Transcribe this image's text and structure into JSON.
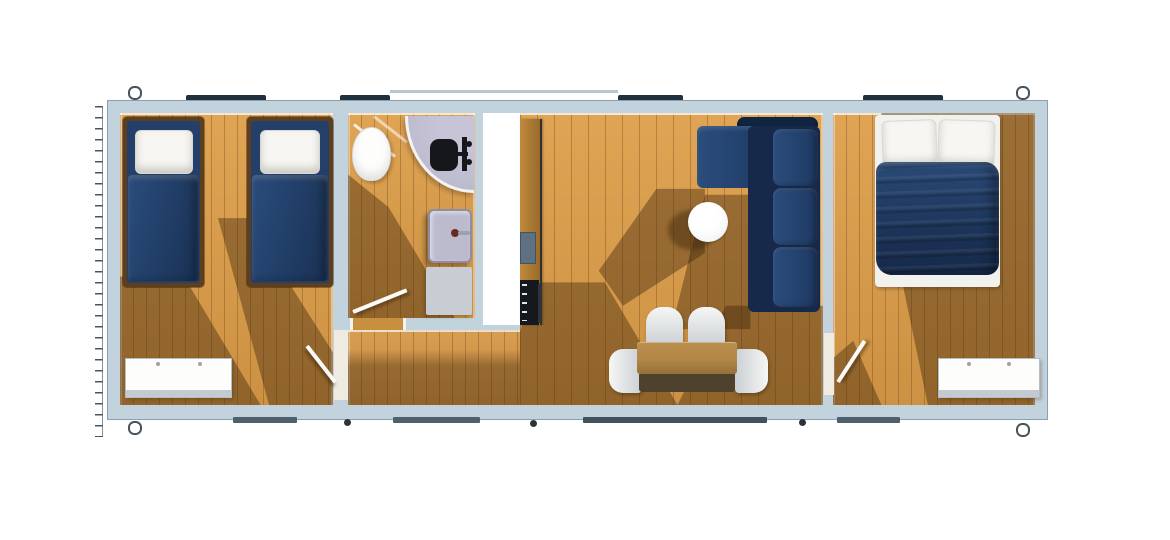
{
  "meta": {
    "kind": "floor-plan-render",
    "view": "top-down",
    "modules": 3
  },
  "colors": {
    "wall": "#c3d3dd",
    "wall_edge": "#8aa0ae",
    "floor_a": "#e0a455",
    "floor_b": "#cd9143",
    "win_dark": "#20303d",
    "win_gray": "#4e606c",
    "dot": "#2b343c",
    "frame": "#5e3f1d",
    "bolster": "#24406a",
    "duvet_a": "#2b4c7c",
    "duvet_b": "#1a3153",
    "sofa_hi": "#2b4d7c",
    "sofa_lo": "#1e3963",
    "sofa_back": "#112440",
    "sofa_body": "#16294a",
    "fixture": "#bcbacd",
    "fixture_rim": "#f2f3f5",
    "mat": "#c8ccd3",
    "appliance": "#15181d",
    "ksink": "#5d7183",
    "counter_a": "#c08a3d",
    "counter_b": "#9a6a2c",
    "table_top": "#b28747",
    "table_face": "#4e422d",
    "leaf": "#fbfaf6",
    "opening": "#f0ebe1",
    "void": "#ffffff"
  },
  "rooms": [
    {
      "id": "bedroom-1",
      "objects": [
        "single-bed-1",
        "single-bed-2",
        "wardrobe",
        "door"
      ]
    },
    {
      "id": "bathroom",
      "objects": [
        "toilet",
        "corner-shower",
        "shower-head",
        "wash-basin",
        "bath-mat",
        "door"
      ]
    },
    {
      "id": "hallway",
      "objects": []
    },
    {
      "id": "kitchen-living",
      "objects": [
        "kitchen-counter",
        "kitchen-sink",
        "cooktop",
        "corner-sofa",
        "round-side-table",
        "dining-table",
        "dining-chair",
        "dining-chair",
        "dining-chair",
        "dining-chair"
      ]
    },
    {
      "id": "bedroom-2",
      "objects": [
        "double-bed",
        "wardrobe",
        "door"
      ]
    }
  ],
  "exterior": {
    "windows_top": 4,
    "windows_bottom": 4,
    "corner_fittings": 4,
    "wall_anchors": 3,
    "left_ruler_ticks": true
  }
}
